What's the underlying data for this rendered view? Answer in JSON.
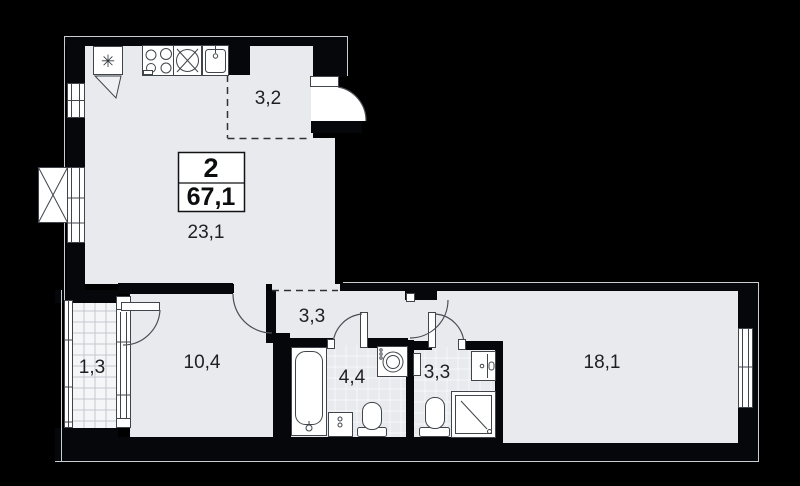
{
  "plan": {
    "title": "2-room apartment floor plan",
    "info_box": {
      "rooms_count": "2",
      "total_area": "67,1"
    },
    "rooms": {
      "entry_hall": {
        "area": "3,2"
      },
      "kitchen_living": {
        "area": "23,1"
      },
      "corridor": {
        "area": "3,3"
      },
      "room_small": {
        "area": "10,4"
      },
      "balcony": {
        "area": "1,3"
      },
      "bathroom": {
        "area": "4,4"
      },
      "wc": {
        "area": "3,3"
      },
      "bedroom": {
        "area": "18,1"
      }
    },
    "icons": {
      "fridge_glyph": "✳"
    },
    "colors": {
      "background": "#000000",
      "floor": "#e8eaee",
      "wall": "#06070a",
      "fixture_fill": "#ffffff",
      "hairline": "#c9ced4",
      "label": "#1d1f23"
    }
  }
}
